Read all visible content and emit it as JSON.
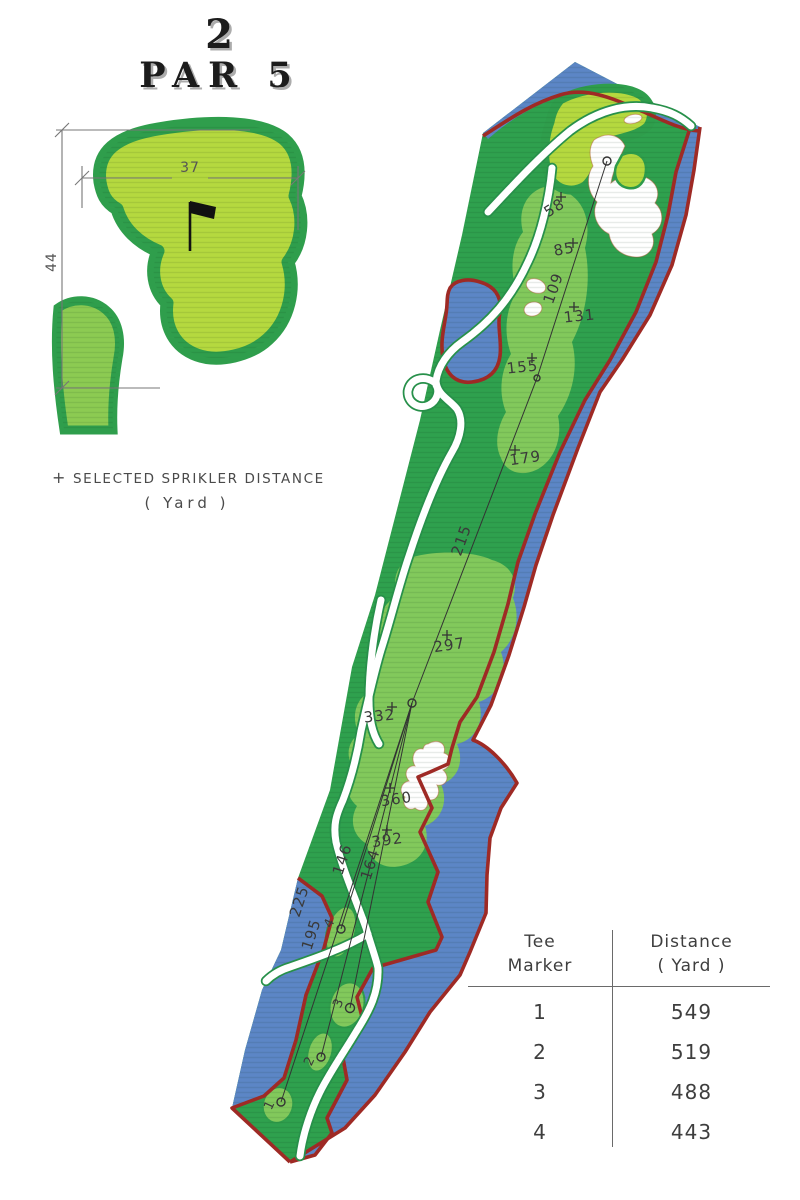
{
  "title": {
    "hole_number": "2",
    "par_label": "PAR 5"
  },
  "green_detail": {
    "width_yards": "37",
    "depth_yards": "44"
  },
  "legend": {
    "marker_symbol": "+",
    "text": "SELECTED SPRIKLER DISTANCE",
    "unit": "( Yard )"
  },
  "hole_map": {
    "sprinkler_distances": [
      "58",
      "85",
      "109",
      "131",
      "155",
      "179",
      "215",
      "297",
      "332",
      "360",
      "392"
    ],
    "tee_line_distances": [
      "164",
      "146",
      "225",
      "195"
    ],
    "tee_markers": [
      "4",
      "3",
      "2",
      "1"
    ]
  },
  "tee_table": {
    "header": {
      "col1_line1": "Tee",
      "col1_line2": "Marker",
      "col2_line1": "Distance",
      "col2_line2": "( Yard )"
    },
    "rows": [
      {
        "tee": "1",
        "distance": "549"
      },
      {
        "tee": "2",
        "distance": "519"
      },
      {
        "tee": "3",
        "distance": "488"
      },
      {
        "tee": "4",
        "distance": "443"
      }
    ]
  },
  "colors": {
    "rough": "#2fa14e",
    "fairway": "#82c95c",
    "green_surface": "#b5d93f",
    "fringe": "#2f9e4c",
    "water": "#5c86c6",
    "hazard_line": "#9e2a25",
    "cart_path": "#ffffff"
  }
}
